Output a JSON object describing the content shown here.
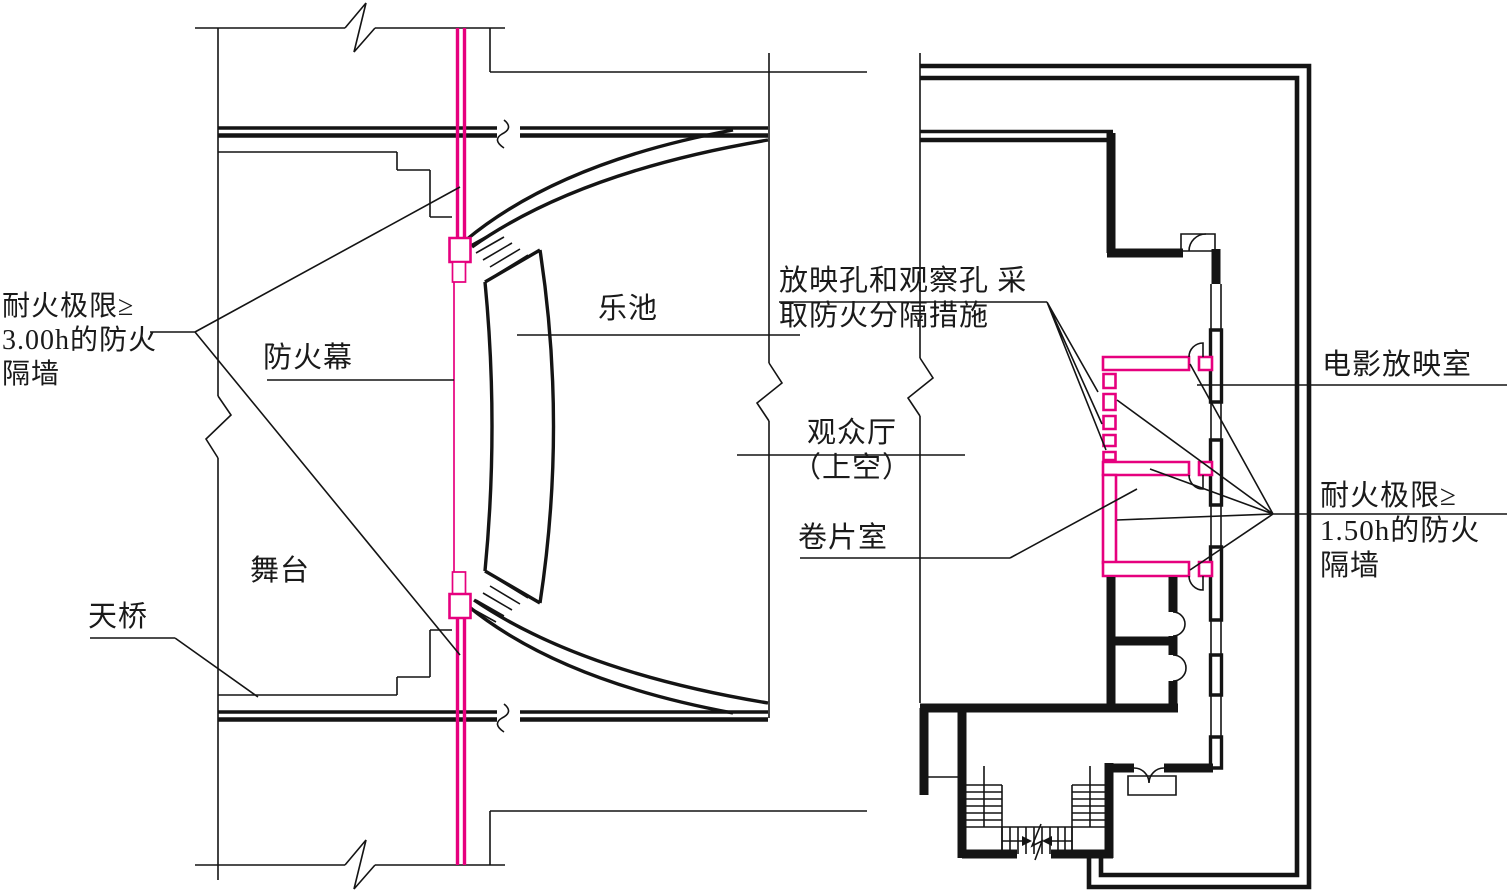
{
  "colors": {
    "line": "#141414",
    "fire_protection": "#E6007E",
    "background": "#ffffff"
  },
  "labels": {
    "fire_wall_3h": {
      "line1": "耐火极限≥",
      "line2": "3.00h的防火",
      "line3": "隔墙"
    },
    "fire_curtain": "防火幕",
    "orchestra_pit": "乐池",
    "stage": "舞台",
    "catwalk": "天桥",
    "audience_hall": {
      "line1": "观众厅",
      "line2": "（上空）"
    },
    "projection_holes": {
      "line1": "放映孔和观察孔 采",
      "line2": "取防火分隔措施"
    },
    "projection_room": "电影放映室",
    "rewind_room": "卷片室",
    "fire_wall_15h": {
      "line1": "耐火极限≥",
      "line2": "1.50h的防火",
      "line3": "隔墙"
    }
  }
}
